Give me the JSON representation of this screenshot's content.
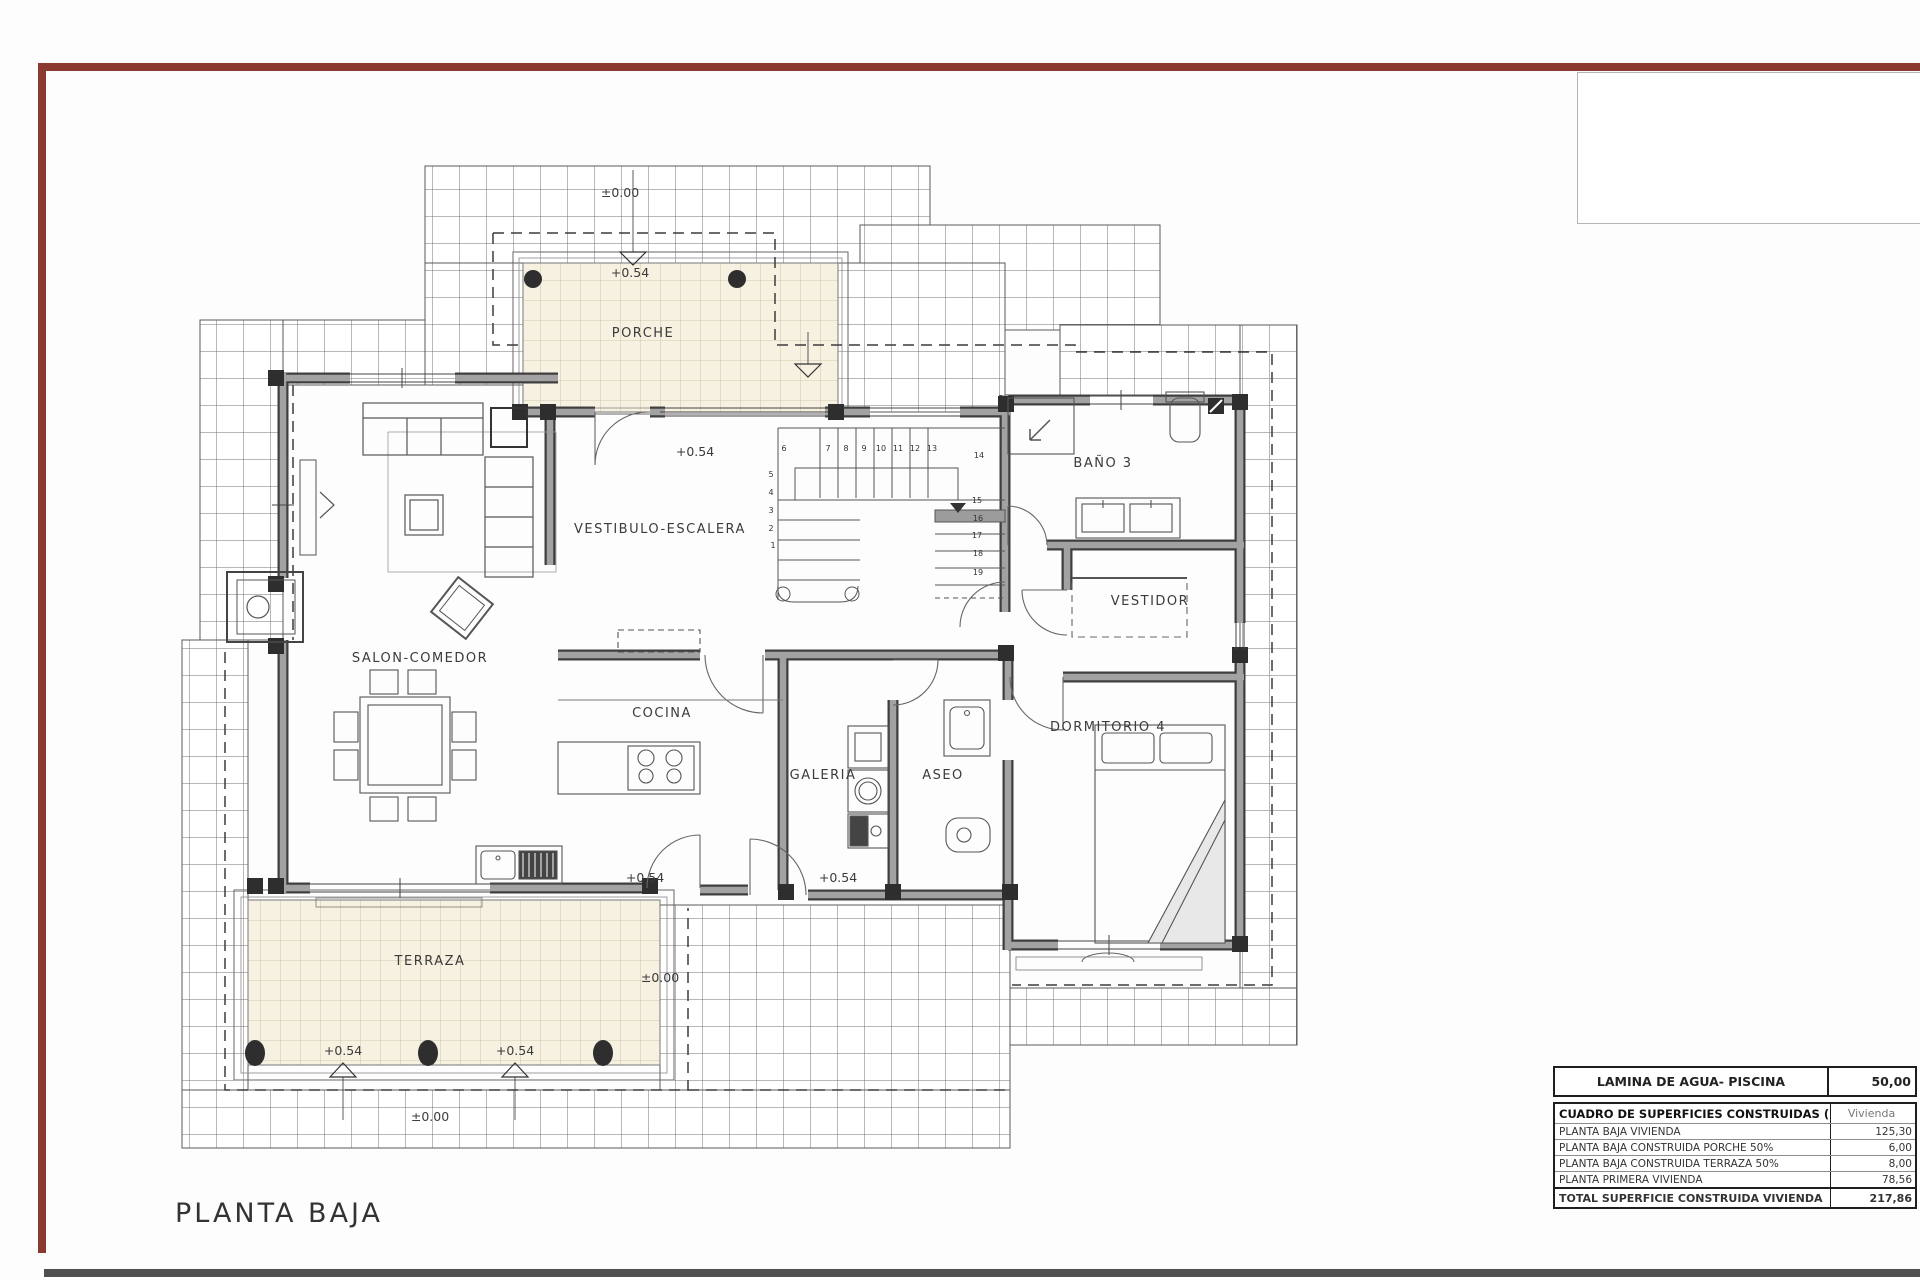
{
  "page": {
    "title": "PLANTA BAJA"
  },
  "colors": {
    "frame_maroon": "#8a3a30",
    "bottom_rule": "#4f4f4f",
    "wall_gray": "#a0a0a0",
    "wall_edge": "#3f3f3f",
    "tile_cream": "#f6f1e0",
    "drawing_line": "#555555"
  },
  "plan": {
    "rooms": [
      {
        "label": "PORCHE"
      },
      {
        "label": "VESTIBULO-ESCALERA"
      },
      {
        "label": "BAÑO 3"
      },
      {
        "label": "VESTIDOR"
      },
      {
        "label": "SALON-COMEDOR"
      },
      {
        "label": "COCINA"
      },
      {
        "label": "GALERIA"
      },
      {
        "label": "ASEO"
      },
      {
        "label": "DORMITORIO 4"
      },
      {
        "label": "TERRAZA"
      }
    ],
    "levels": [
      {
        "label": "±0.00"
      },
      {
        "label": "+0.54"
      },
      {
        "label": "+0.54"
      },
      {
        "label": "+0.54"
      },
      {
        "label": "+0.54"
      },
      {
        "label": "±0.00"
      },
      {
        "label": "+0.54"
      },
      {
        "label": "+0.54"
      },
      {
        "label": "±0.00"
      }
    ],
    "stairs": {
      "numbers": [
        "1",
        "2",
        "3",
        "4",
        "5",
        "6",
        "7",
        "8",
        "9",
        "10",
        "11",
        "12",
        "13",
        "14",
        "15",
        "16",
        "17",
        "18",
        "19"
      ]
    }
  },
  "tables": {
    "pool": {
      "label": "LAMINA DE AGUA- PISCINA",
      "value": "50,00"
    },
    "surfaces": {
      "header_label": "CUADRO DE SUPERFICIES CONSTRUIDAS (m2)",
      "header_value": "Vivienda",
      "rows": [
        {
          "label": "PLANTA BAJA VIVIENDA",
          "value": "125,30"
        },
        {
          "label": "PLANTA BAJA CONSTRUIDA PORCHE 50%",
          "value": "6,00"
        },
        {
          "label": "PLANTA BAJA CONSTRUIDA TERRAZA 50%",
          "value": "8,00"
        },
        {
          "label": "PLANTA PRIMERA VIVIENDA",
          "value": "78,56"
        }
      ],
      "total": {
        "label": "TOTAL SUPERFICIE CONSTRUIDA VIVIENDA",
        "value": "217,86"
      }
    }
  }
}
